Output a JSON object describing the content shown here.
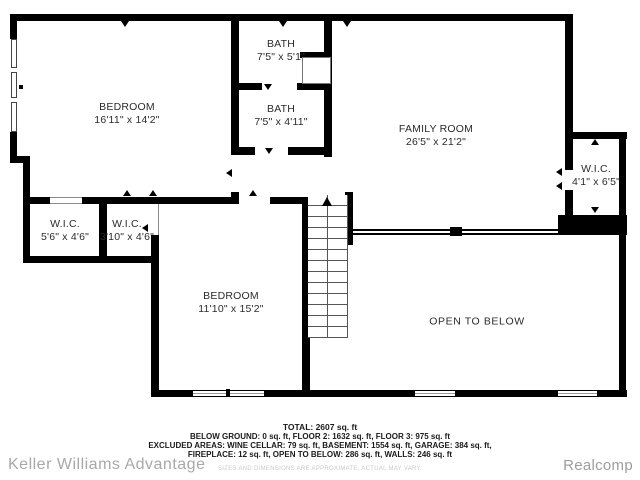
{
  "floorplan": {
    "rooms": [
      {
        "name": "BEDROOM",
        "dims": "16'11\" x 14'2\""
      },
      {
        "name": "BATH",
        "dims": "7'5\" x 5'1\""
      },
      {
        "name": "BATH",
        "dims": "7'5\" x 4'11\""
      },
      {
        "name": "FAMILY ROOM",
        "dims": "26'5\" x 21'2\""
      },
      {
        "name": "W.I.C.",
        "dims": "4'1\" x 6'5\""
      },
      {
        "name": "W.I.C.",
        "dims": "5'6\" x 4'6\""
      },
      {
        "name": "W.I.C.",
        "dims": "3'10\" x 4'6\""
      },
      {
        "name": "BEDROOM",
        "dims": "11'10\" x 15'2\""
      },
      {
        "name": "OPEN TO BELOW",
        "dims": ""
      }
    ],
    "summary": {
      "total": "TOTAL: 2607 sq. ft",
      "line1": "BELOW GROUND: 0 sq. ft, FLOOR 2: 1632 sq. ft, FLOOR 3: 975 sq. ft",
      "line2": "EXCLUDED AREAS: WINE CELLAR: 79 sq. ft, BASEMENT: 1554 sq. ft, GARAGE: 384 sq. ft,",
      "line3": "FIREPLACE: 12 sq. ft, OPEN TO BELOW: 286 sq. ft, WALLS: 246 sq. ft",
      "disclaimer": "SIZES AND DIMENSIONS ARE APPROXIMATE, ACTUAL MAY VARY."
    },
    "branding": {
      "agency": "Keller Williams Advantage",
      "provider": "Realcomp"
    },
    "colors": {
      "wall": "#000000",
      "label_text": "#2b2b2b",
      "branding_gray": "#a8a8a8"
    }
  }
}
